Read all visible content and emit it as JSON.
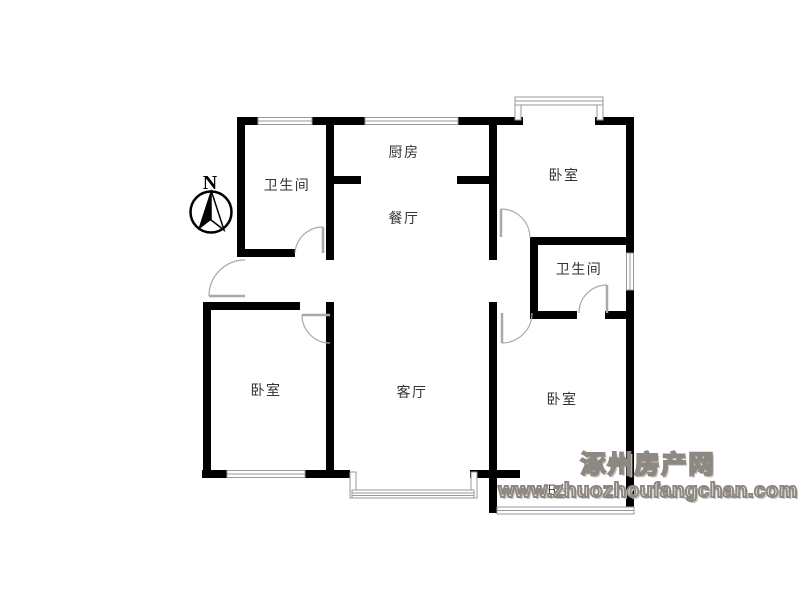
{
  "colors": {
    "wall": "#000000",
    "window": "#9a9a9a",
    "door": "#a9a9a9",
    "label": "#333333",
    "watermark_outline": "#8d8881",
    "background": "#ffffff"
  },
  "compass": {
    "north_label": "N"
  },
  "rooms": {
    "bathroom_top": {
      "label": "卫生间"
    },
    "kitchen": {
      "label": "厨房"
    },
    "dining": {
      "label": "餐厅"
    },
    "bedroom_top_right": {
      "label": "卧室"
    },
    "bathroom_right": {
      "label": "卫生间"
    },
    "bedroom_left": {
      "label": "卧室"
    },
    "living": {
      "label": "客厅"
    },
    "bedroom_bottom_right": {
      "label": "卧室"
    },
    "balcony": {
      "label": "阳台"
    }
  },
  "watermark": {
    "site_name": "涿州房产网",
    "site_url": "www.zhuozhoufangchan.com"
  }
}
